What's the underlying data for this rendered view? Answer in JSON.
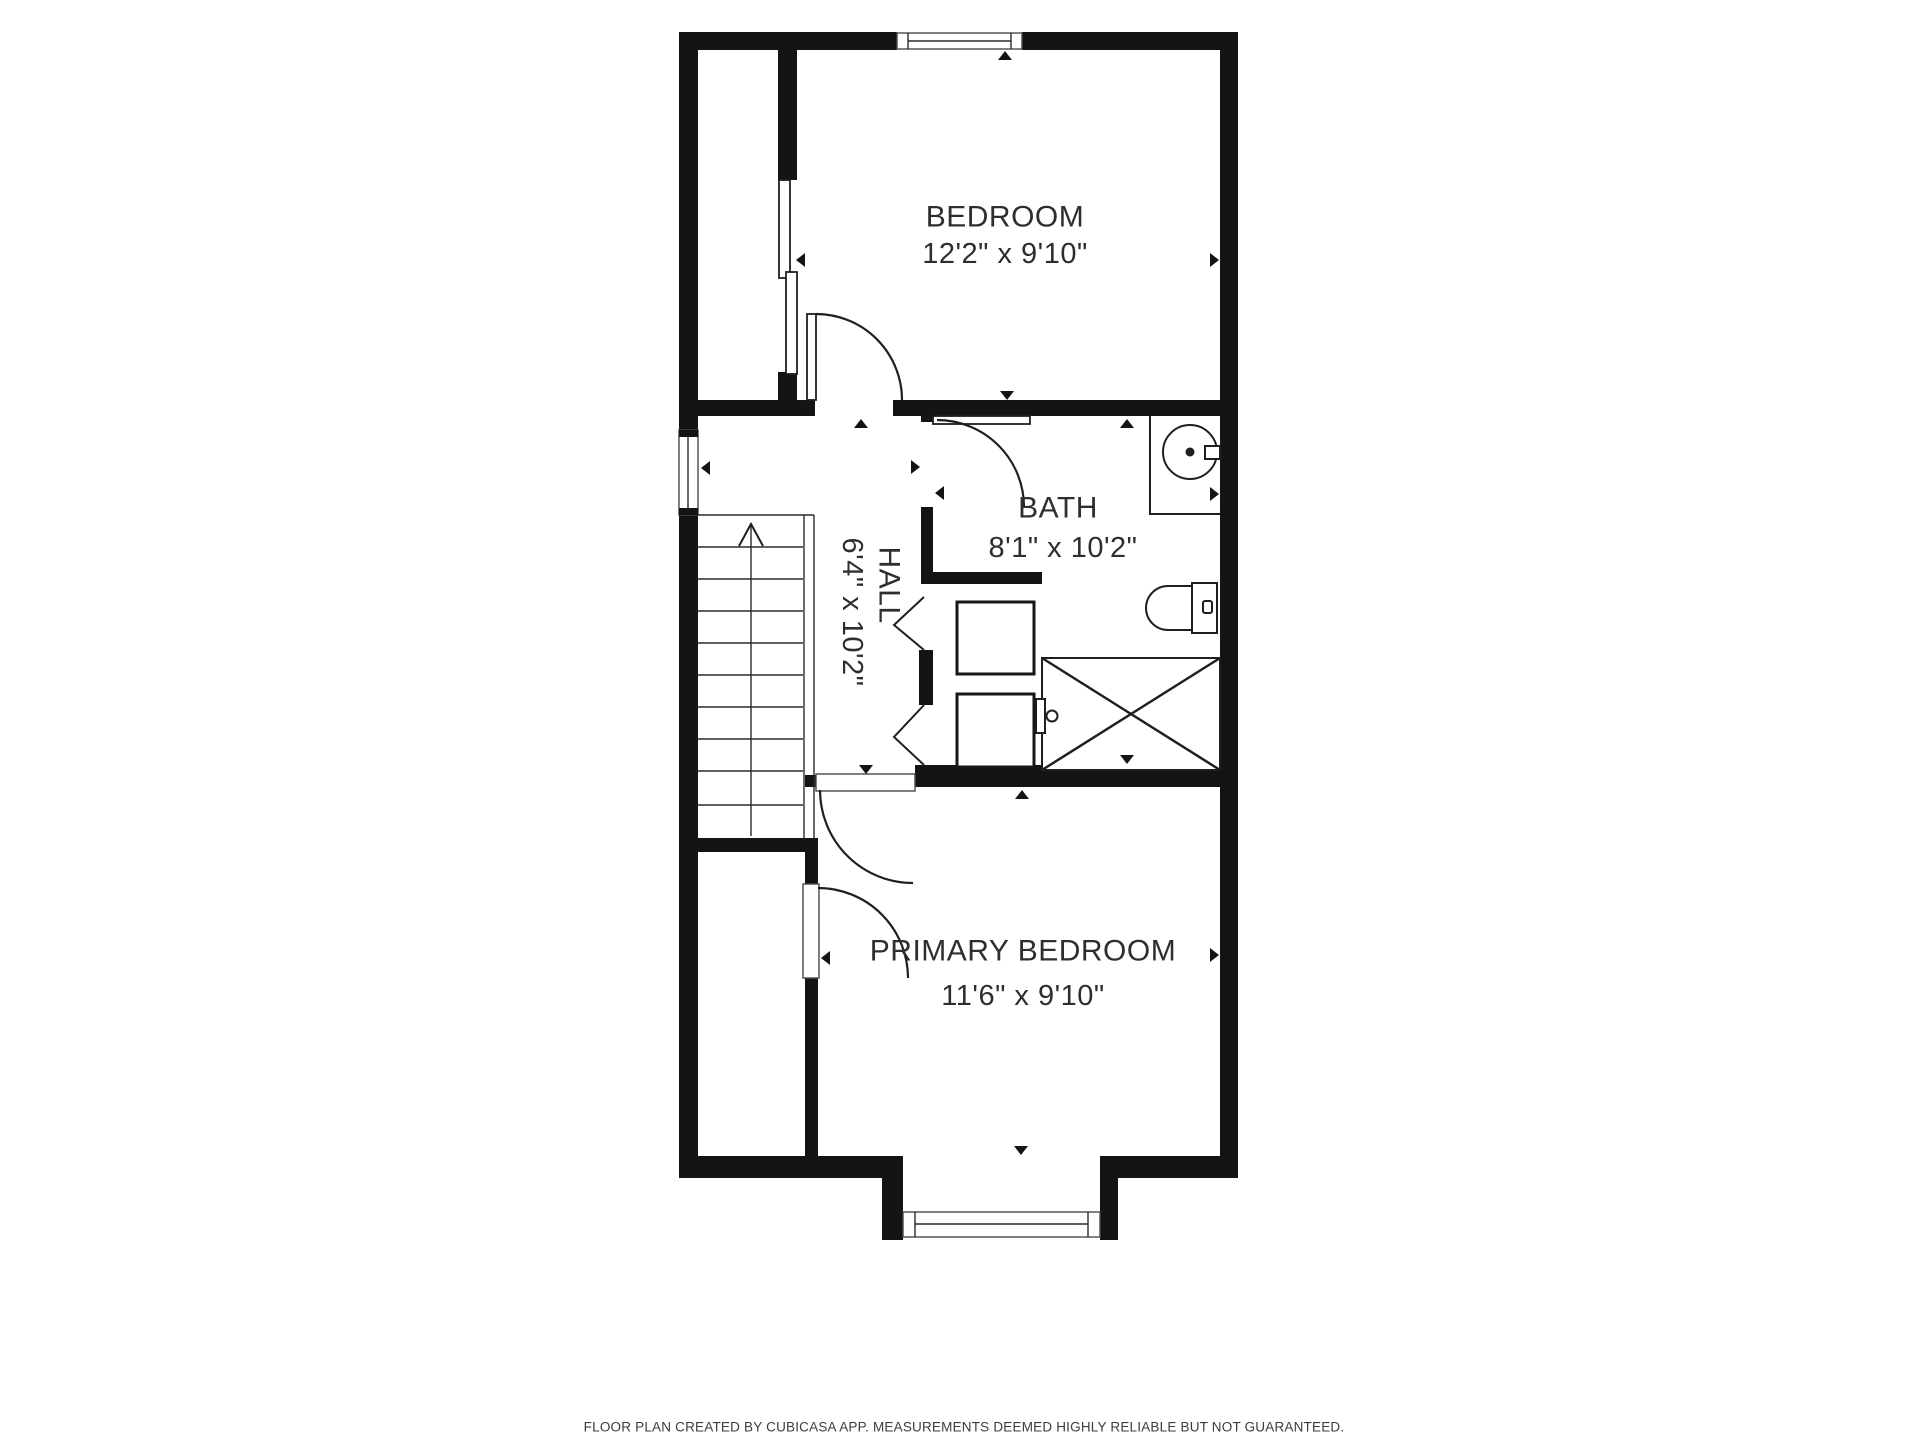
{
  "floor_plan": {
    "rooms": {
      "bedroom": {
        "name": "BEDROOM",
        "dimensions": "12'2\" x 9'10\""
      },
      "bath": {
        "name": "BATH",
        "dimensions": "8'1\" x 10'2\""
      },
      "hall": {
        "name": "HALL",
        "dimensions": "6'4\" x 10'2\""
      },
      "primary_bedroom": {
        "name": "PRIMARY BEDROOM",
        "dimensions": "11'6\" x 9'10\""
      }
    },
    "footer_disclaimer": "FLOOR PLAN CREATED BY CUBICASA APP. MEASUREMENTS DEEMED HIGHLY RELIABLE BUT NOT GUARANTEED.",
    "colors": {
      "walls": "#141414",
      "fixture_lines": "#1f1f1f",
      "label_text": "#2e2e2e",
      "background": "#ffffff"
    }
  }
}
